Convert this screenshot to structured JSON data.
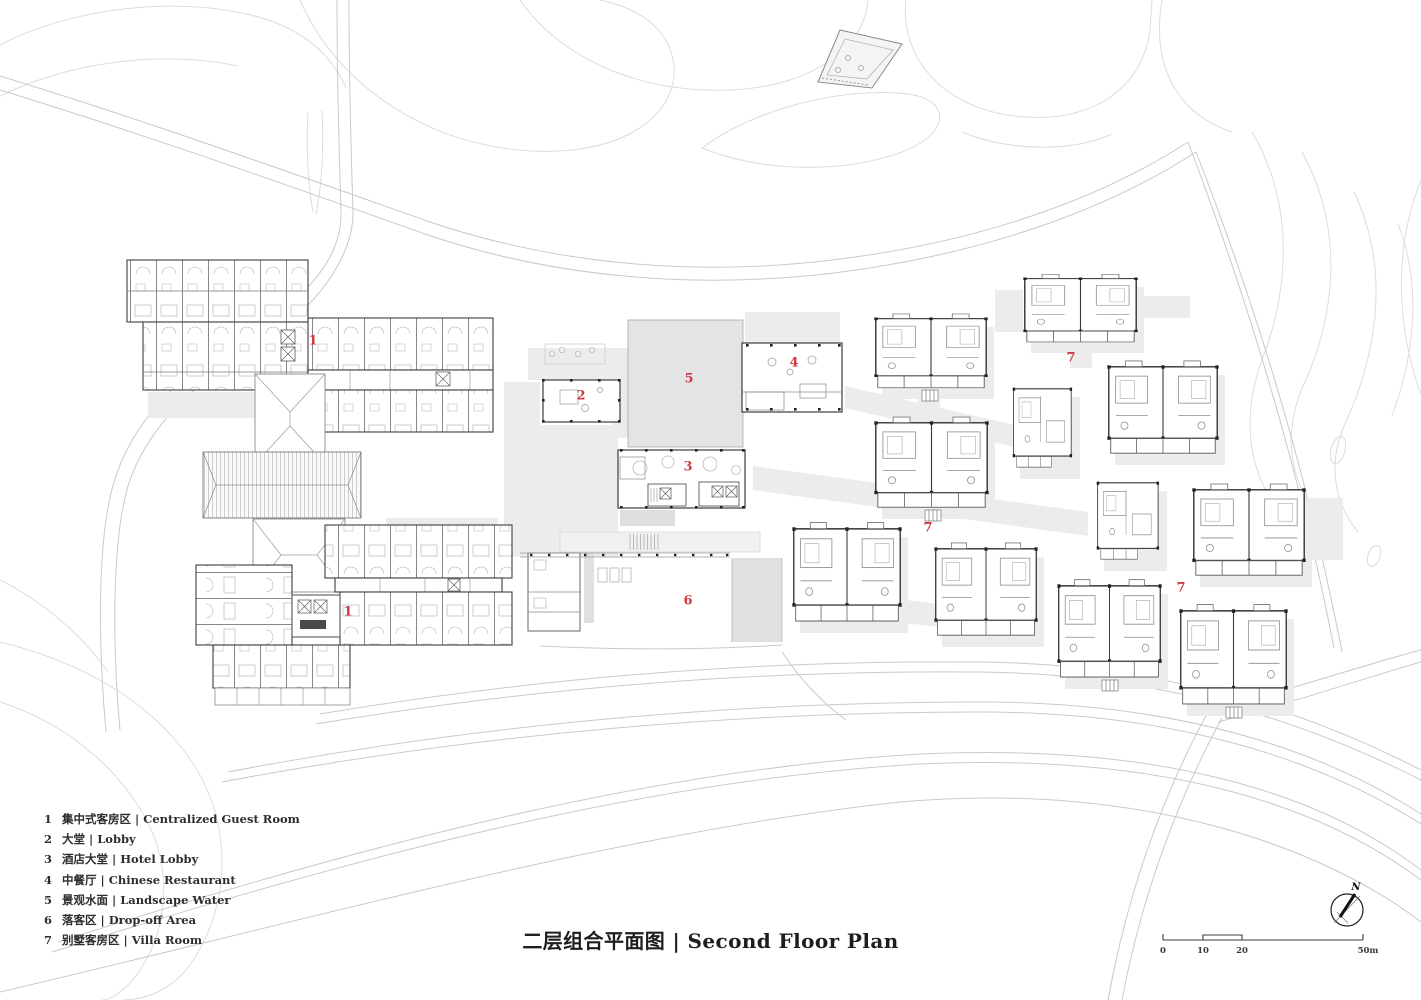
{
  "title": {
    "text": "二层组合平面图 | Second Floor Plan"
  },
  "legend": {
    "items": [
      {
        "num": "1",
        "label": "集中式客房区 | Centralized Guest Room"
      },
      {
        "num": "2",
        "label": "大堂 | Lobby"
      },
      {
        "num": "3",
        "label": "酒店大堂 | Hotel Lobby"
      },
      {
        "num": "4",
        "label": "中餐厅 | Chinese Restaurant"
      },
      {
        "num": "5",
        "label": "景观水面 | Landscape Water"
      },
      {
        "num": "6",
        "label": "落客区 | Drop-off Area"
      },
      {
        "num": "7",
        "label": "别墅客房区 | Villa Room"
      }
    ]
  },
  "plan_labels": [
    {
      "num": "1",
      "x": 313,
      "y": 341
    },
    {
      "num": "2",
      "x": 581,
      "y": 396
    },
    {
      "num": "5",
      "x": 689,
      "y": 379
    },
    {
      "num": "4",
      "x": 794,
      "y": 363
    },
    {
      "num": "7",
      "x": 1071,
      "y": 358
    },
    {
      "num": "3",
      "x": 688,
      "y": 467
    },
    {
      "num": "7",
      "x": 928,
      "y": 528
    },
    {
      "num": "1",
      "x": 348,
      "y": 612
    },
    {
      "num": "6",
      "x": 688,
      "y": 601
    },
    {
      "num": "7",
      "x": 1181,
      "y": 588
    }
  ],
  "scale_bar": {
    "tick0": "0",
    "tick10": "10",
    "tick20": "20",
    "tick_end": "50m"
  },
  "compass": {
    "north_label": "N"
  },
  "colors": {
    "accent_red": "#cd3a44",
    "line_dark": "#3d3d3d",
    "line_light": "#dcdcdc",
    "gray_fill": "#ececec"
  }
}
